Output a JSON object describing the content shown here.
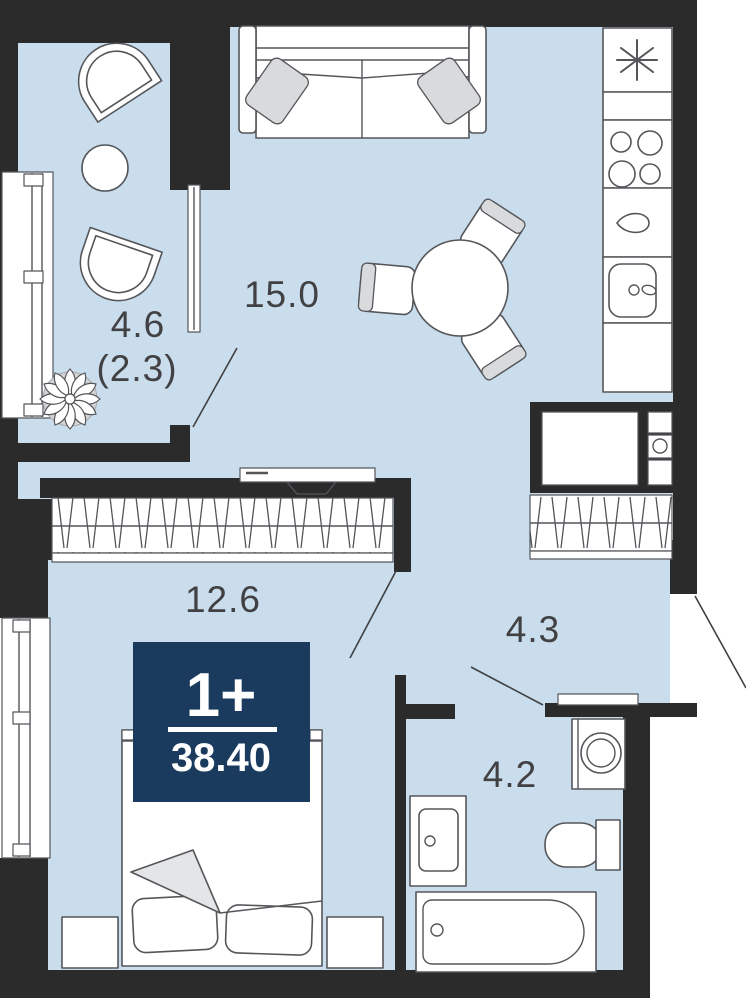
{
  "floor_plan": {
    "badge": {
      "rooms_label": "1+",
      "area_value": "38.40"
    },
    "rooms": {
      "living": {
        "area": "15.0"
      },
      "balcony": {
        "area": "4.6",
        "area_secondary": "(2.3)"
      },
      "bedroom": {
        "area": "12.6"
      },
      "hallway": {
        "area": "4.3"
      },
      "bathroom": {
        "area": "4.2"
      }
    },
    "icons": {
      "freezer": "snowflake-asterisk",
      "stove": "four-burners",
      "kitchen_sink": "basin-with-tap",
      "bath_drop": "water-drop"
    },
    "colors": {
      "floor": "#c9ddec",
      "walls": "#2b2b2c",
      "badge_bg": "#1a3a5e",
      "badge_text": "#ffffff",
      "furniture_line": "#55565a",
      "label_text": "#414042",
      "accent_gray": "#d8dadb"
    }
  }
}
